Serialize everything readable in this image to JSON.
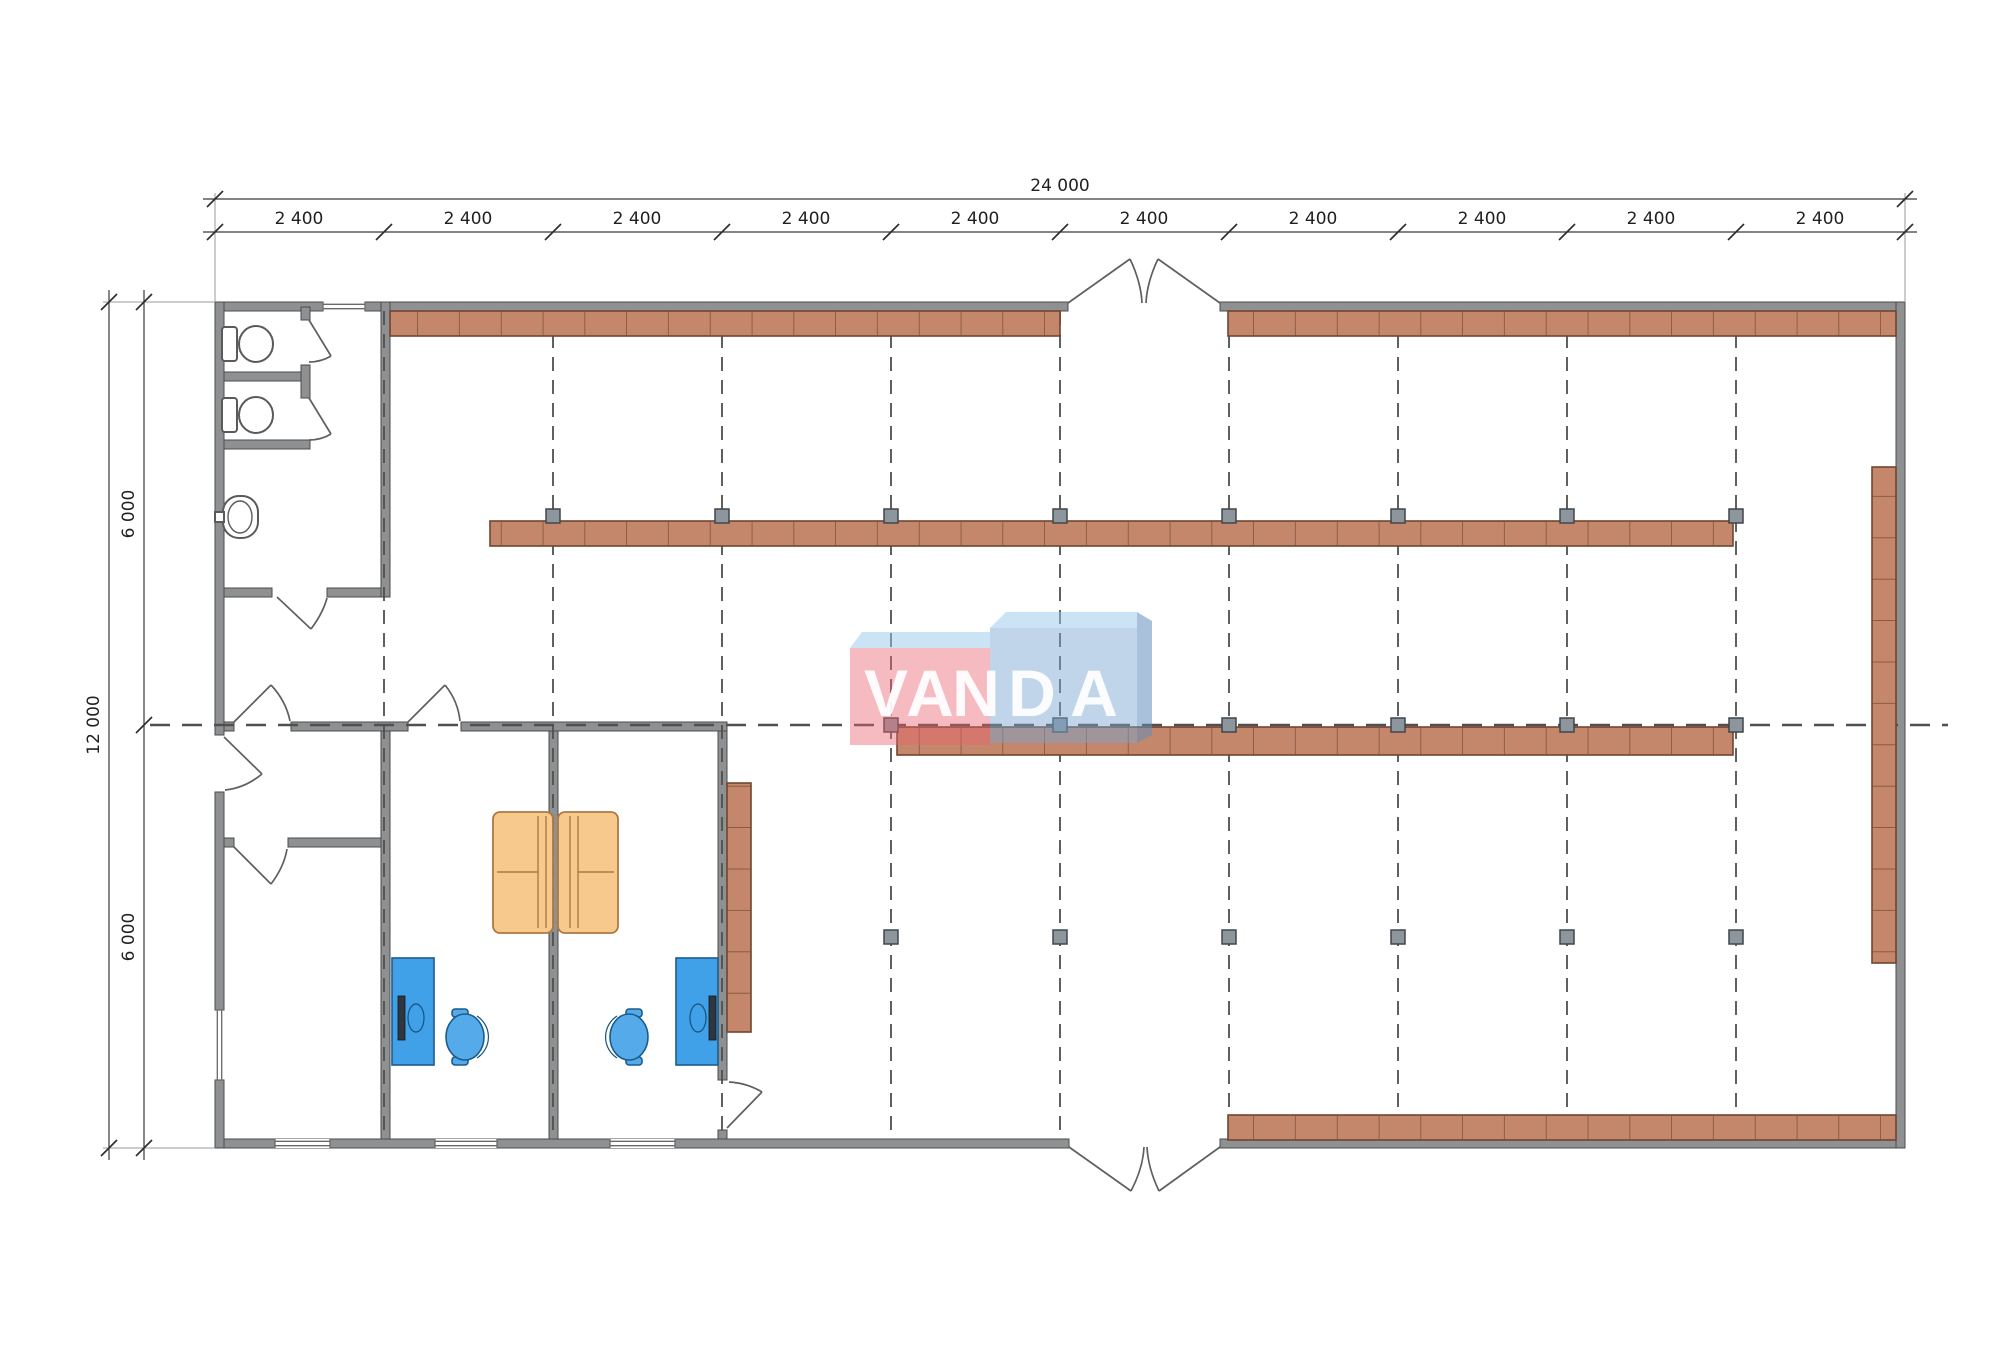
{
  "dimensions": {
    "top_total": "24 000",
    "top_segments": [
      "2 400",
      "2 400",
      "2 400",
      "2 400",
      "2 400",
      "2 400",
      "2 400",
      "2 400",
      "2 400",
      "2 400"
    ],
    "left_total": "12 000",
    "left_segments": [
      "6 000",
      "6 000"
    ]
  },
  "logo": {
    "text": "VANDA",
    "letters": [
      "V",
      "A",
      "N",
      "D",
      "A"
    ],
    "red_front": "rgba(233,100,112,0.44)",
    "top_face": "rgba(150,200,235,0.50)",
    "blue_front": "rgba(122,166,210,0.47)",
    "blue_side": "rgba(98,142,188,0.55)",
    "letter_color": "rgba(255,255,255,0.93)"
  },
  "colors": {
    "wall_fill": "#8f9092",
    "shelf_fill": "#c4876c",
    "column_fill": "#8d969d",
    "desk_blue": "#41a1e8",
    "chair_blue": "#55abe9",
    "couch_tan": "#f8c98c",
    "grid_line": "#4f4f4f",
    "dim_line": "#3a3a3a"
  }
}
